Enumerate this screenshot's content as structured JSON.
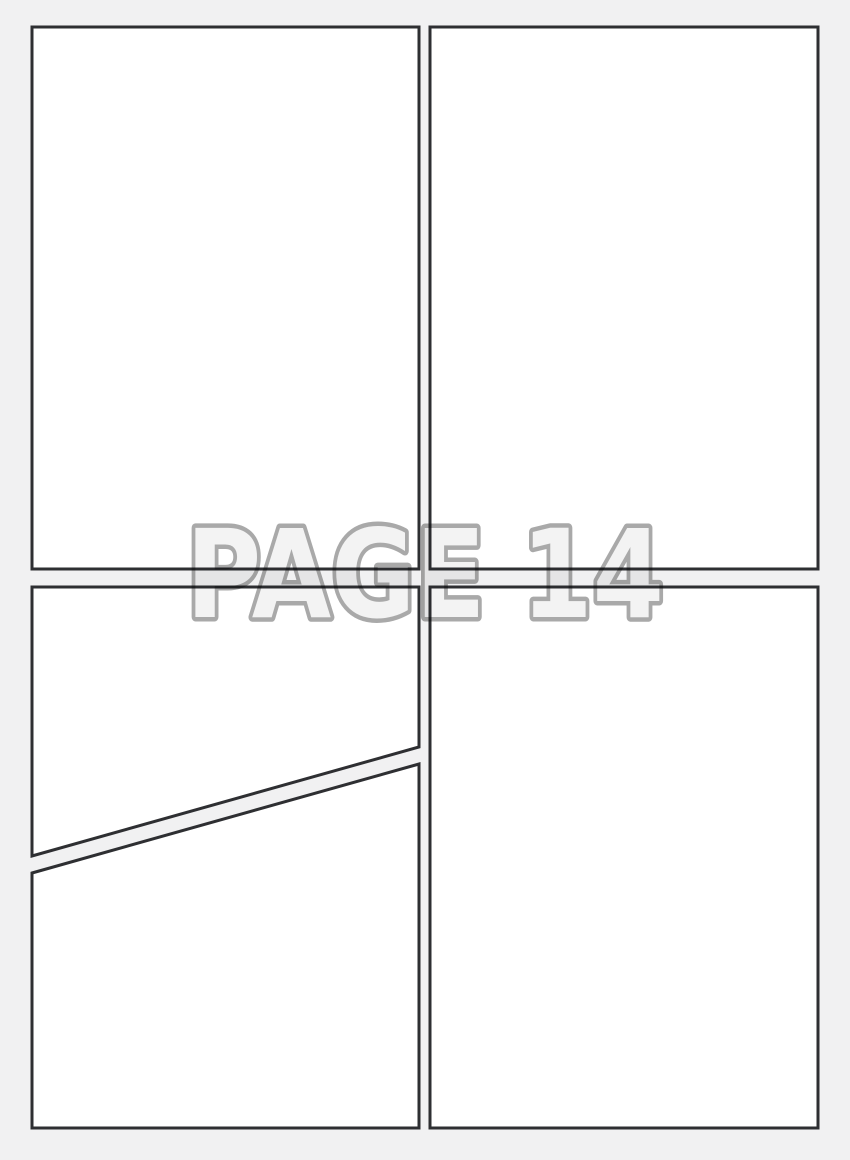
{
  "watermark": {
    "label": "PAGE 14",
    "page_number": "14"
  },
  "colors": {
    "background": "#f1f1f2",
    "panel_fill": "#ffffff",
    "panel_border": "#2e2f32",
    "watermark_fill": "#f3f3f3",
    "watermark_outline": "#a9a9a9"
  },
  "panels": [
    {
      "name": "top-left-panel"
    },
    {
      "name": "top-right-panel"
    },
    {
      "name": "middle-left-diagonal-upper-panel"
    },
    {
      "name": "bottom-left-diagonal-lower-panel"
    },
    {
      "name": "bottom-right-panel"
    }
  ]
}
